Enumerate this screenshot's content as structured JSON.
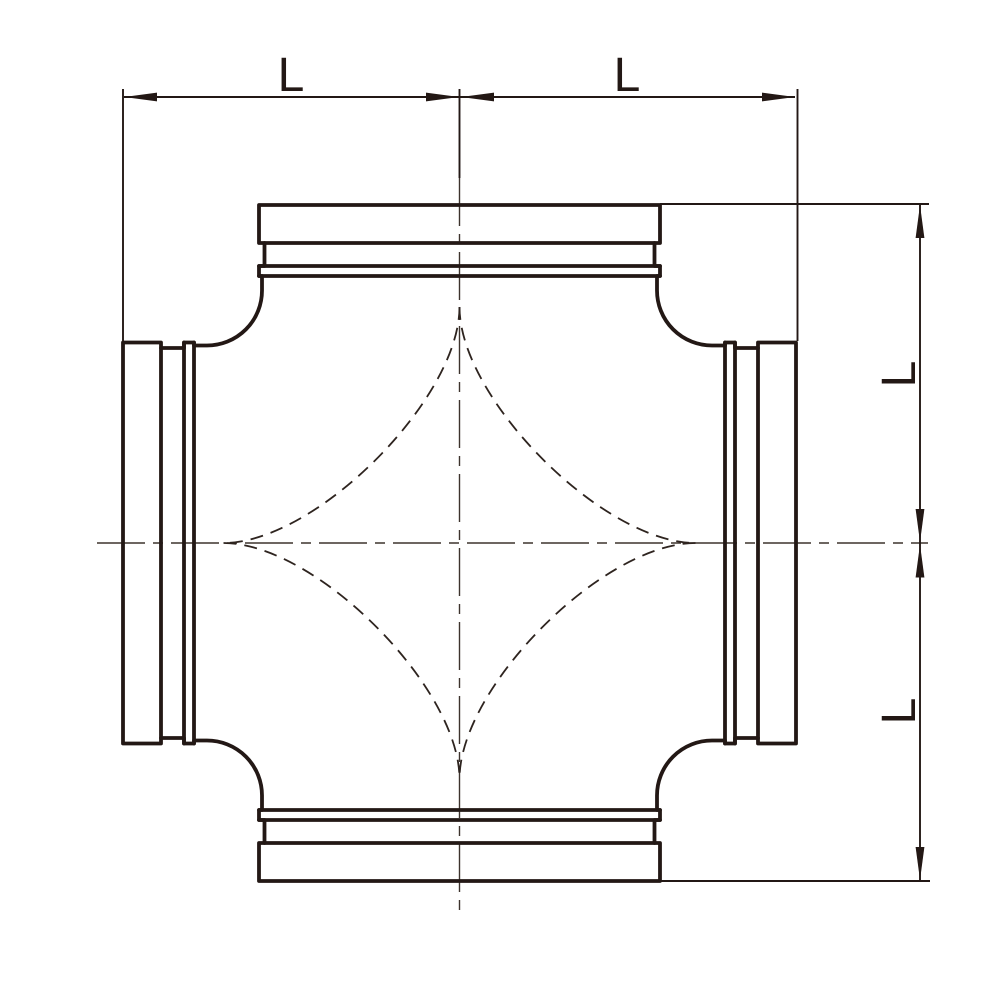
{
  "drawing": {
    "type": "technical-drawing",
    "subject": "cross pipe fitting with grooved ends, front view",
    "colors": {
      "line": "#231815",
      "background": "#ffffff"
    },
    "labels": {
      "dim_top_left": "L",
      "dim_top_right": "L",
      "dim_right_upper": "L",
      "dim_right_lower": "L"
    }
  }
}
